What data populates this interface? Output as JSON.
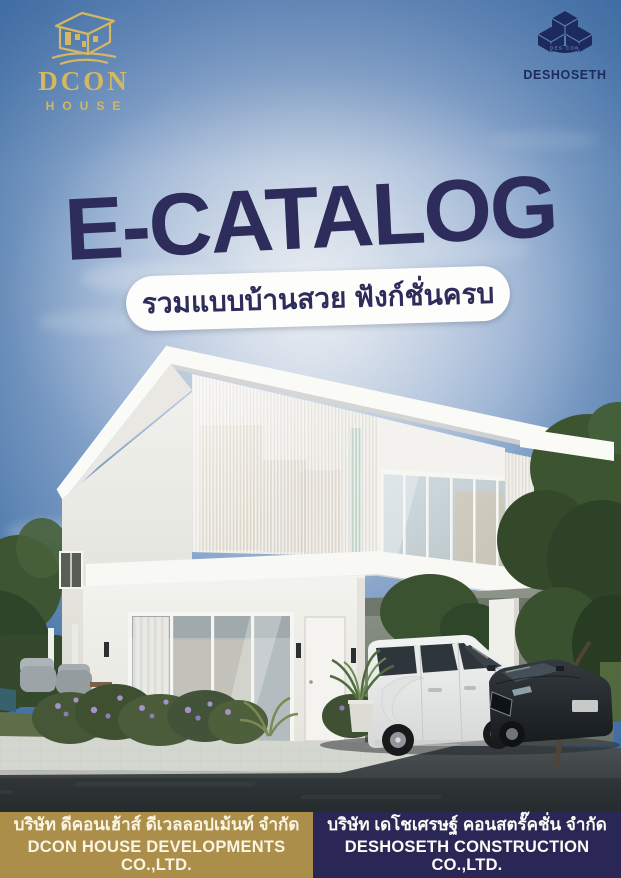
{
  "page": {
    "title": "E-CATALOG",
    "subtitle_th": "รวมแบบบ้านสวย ฟังก์ชั่นครบ"
  },
  "brand_left": {
    "name": "DCON",
    "sub": "HOUSE",
    "icon": "house-line-art-with-swoosh-icon",
    "color": "#d3b761"
  },
  "brand_right": {
    "name": "DESHOSETH",
    "arc": "DES CON",
    "icon": "isometric-cubes-icon",
    "color": "#1d2a5e"
  },
  "footer": {
    "left": {
      "line1_th": "บริษัท ดีคอนเฮ้าส์ ดีเวลลอปเม้นท์ จำกัด",
      "line2_en": "DCON HOUSE DEVELOPMENTS CO.,LTD.",
      "bg": "#ac8e4b"
    },
    "right": {
      "line1_th": "บริษัท เดโชเศรษฐ์ คอนสตรั๊คชั่น จำกัด",
      "line2_en": "DESHOSETH CONSTRUCTION CO.,LTD.",
      "bg": "#2a2756"
    }
  },
  "colors": {
    "headline_navy": "#2d2c5a",
    "sky_top": "#3e6da4",
    "sky_glow": "#d5dde7",
    "house_white": "#f4f3ef",
    "driveway_dark": "#33383a",
    "foliage_green": "#3a5230"
  },
  "photo_description": "modern two-storey white house with louvered facade, carport with white van and dark sedan, garden and stone driveway"
}
